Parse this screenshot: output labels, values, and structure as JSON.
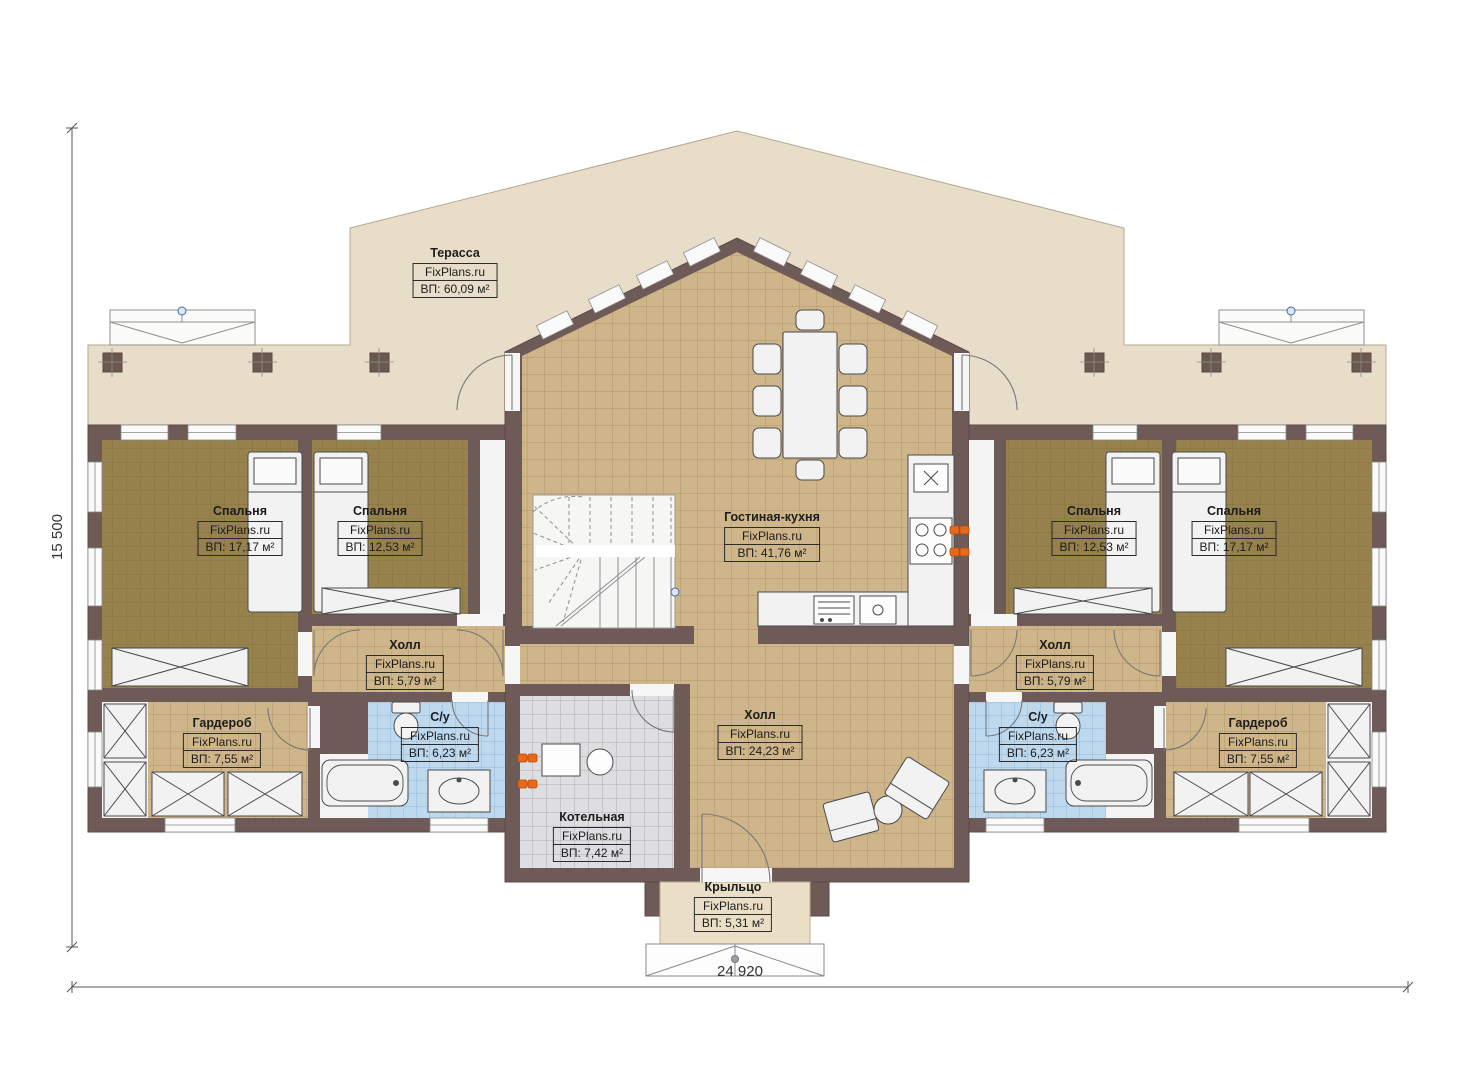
{
  "brand": "FixPlans.ru",
  "dimensions": {
    "width_label": "24 920",
    "height_label": "15 500"
  },
  "rooms": {
    "terrace": {
      "name": "Терасса",
      "area": "ВП: 60,09 м²"
    },
    "bedroom_left_1": {
      "name": "Спальня",
      "area": "ВП: 17,17 м²"
    },
    "bedroom_left_2": {
      "name": "Спальня",
      "area": "ВП: 12,53 м²"
    },
    "living_kitchen": {
      "name": "Гостиная-кухня",
      "area": "ВП: 41,76 м²"
    },
    "bedroom_right_1": {
      "name": "Спальня",
      "area": "ВП: 12,53 м²"
    },
    "bedroom_right_2": {
      "name": "Спальня",
      "area": "ВП: 17,17 м²"
    },
    "hall_left": {
      "name": "Холл",
      "area": "ВП: 5,79 м²"
    },
    "hall_right": {
      "name": "Холл",
      "area": "ВП: 5,79 м²"
    },
    "wardrobe_left": {
      "name": "Гардероб",
      "area": "ВП: 7,55 м²"
    },
    "wardrobe_right": {
      "name": "Гардероб",
      "area": "ВП: 7,55 м²"
    },
    "bath_left": {
      "name": "С/у",
      "area": "ВП: 6,23 м²"
    },
    "bath_right": {
      "name": "С/у",
      "area": "ВП: 6,23 м²"
    },
    "hall_center": {
      "name": "Холл",
      "area": "ВП: 24,23 м²"
    },
    "boiler": {
      "name": "Котельная",
      "area": "ВП: 7,42 м²"
    },
    "porch": {
      "name": "Крыльцо",
      "area": "ВП: 5,31 м²"
    }
  },
  "colors": {
    "wall": "#6e5a56",
    "terrace": "#e7ddc9",
    "porch": "#eadfc6",
    "floor_tan": "#cfb58a",
    "floor_wood": "#97824e",
    "tile_blue": "#bed9ee",
    "tile_gray": "#dedee0",
    "radiator_orange": "#e8681c",
    "marker_blue": "#4466aa"
  }
}
